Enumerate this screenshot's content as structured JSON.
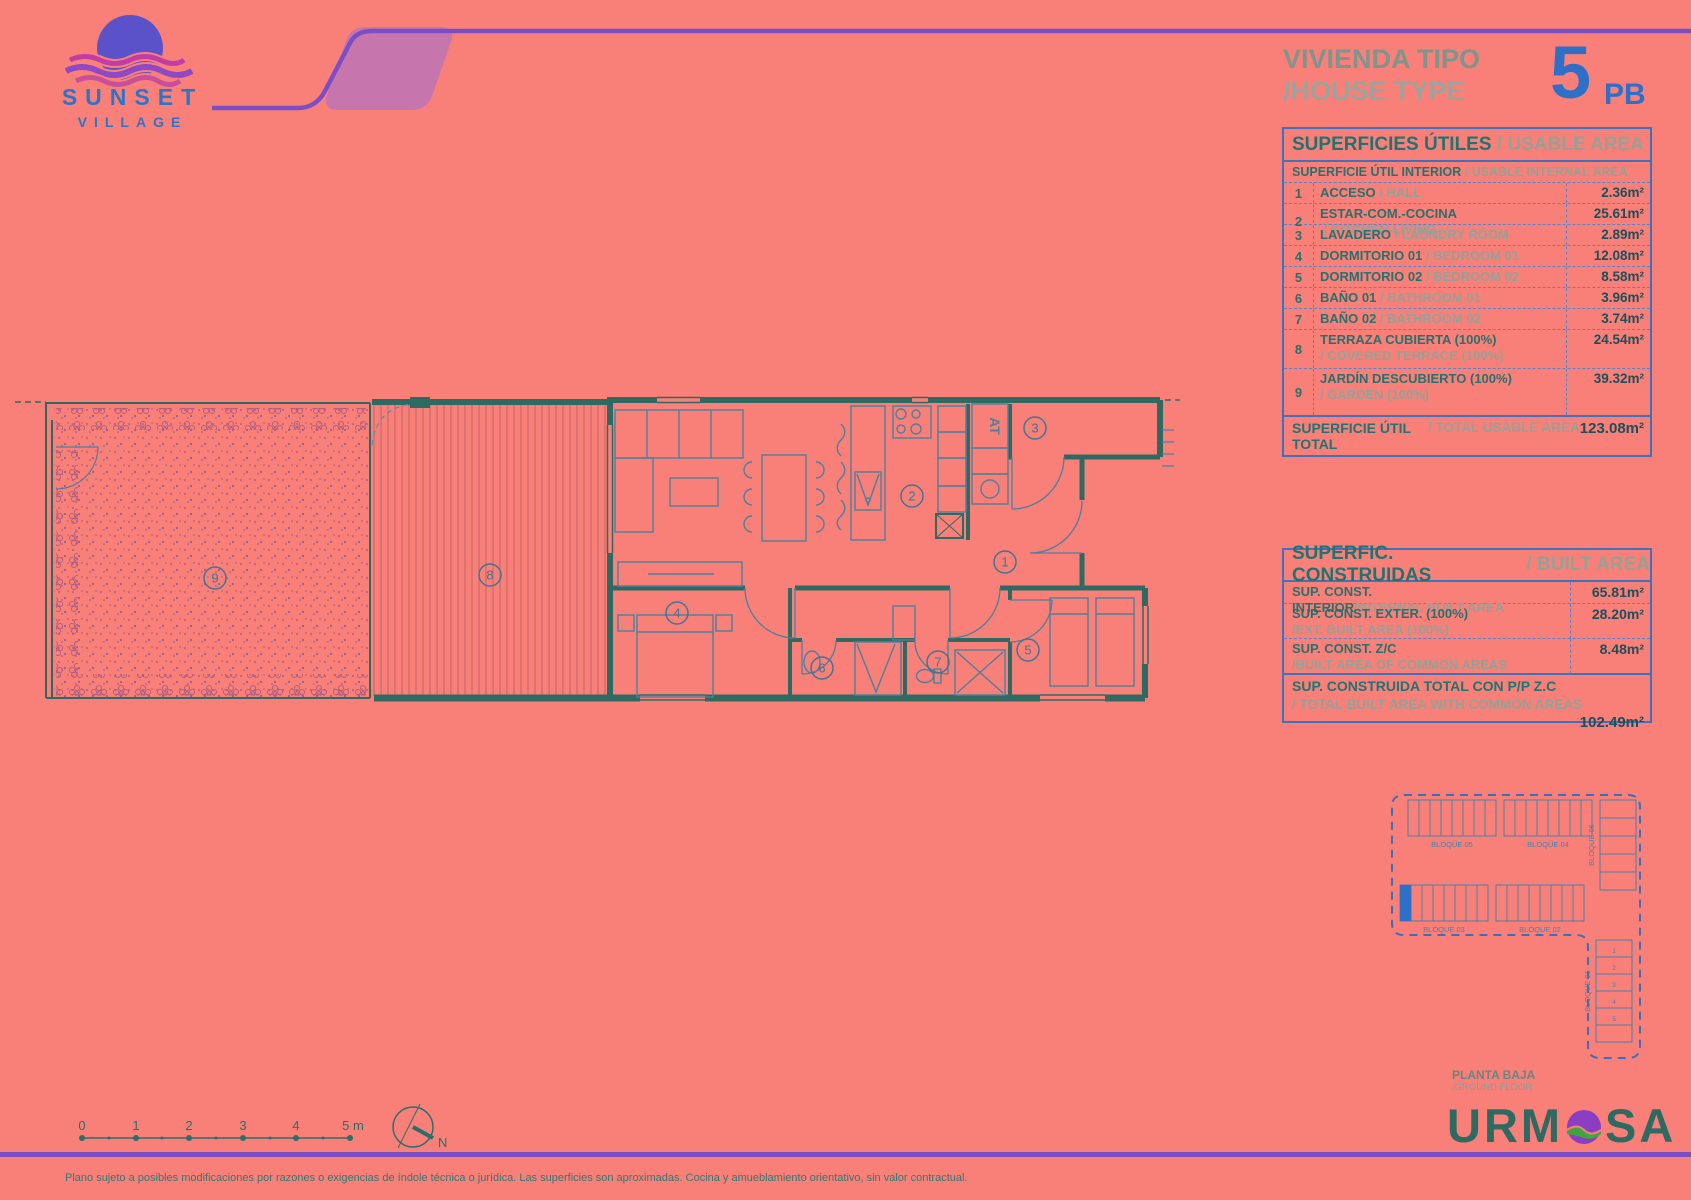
{
  "logo": {
    "name": "SUNSET",
    "subname": "VILLAGE"
  },
  "header": {
    "title_es": "VIVIENDA TIPO",
    "title_en": "/HOUSE TYPE",
    "unit_number": "5",
    "unit_suffix": "PB"
  },
  "usable_table": {
    "title_es": "SUPERFICIES ÚTILES",
    "title_en": " / USABLE AREA",
    "subtitle_es": "SUPERFICIE ÚTIL INTERIOR",
    "subtitle_en": " / USABLE INTERNAL AREA",
    "rows": [
      {
        "num": "1",
        "name_es": "ACCESO",
        "name_en": " / HALL",
        "area": "2.36m²",
        "stacked": false
      },
      {
        "num": "2",
        "name_es": "ESTAR-COM.-COCINA",
        "name_en": " / KITCHEN-LIVING",
        "area": "25.61m²",
        "stacked": false
      },
      {
        "num": "3",
        "name_es": "LAVADERO",
        "name_en": " / LAUNDRY ROOM",
        "area": "2.89m²",
        "stacked": false
      },
      {
        "num": "4",
        "name_es": "DORMITORIO 01",
        "name_en": " / BEDROOM 01",
        "area": "12.08m²",
        "stacked": false
      },
      {
        "num": "5",
        "name_es": "DORMITORIO 02",
        "name_en": " / BEDROOM 02",
        "area": "8.58m²",
        "stacked": false
      },
      {
        "num": "6",
        "name_es": "BAÑO 01",
        "name_en": " / BATHROOM 01",
        "area": "3.96m²",
        "stacked": false
      },
      {
        "num": "7",
        "name_es": "BAÑO 02",
        "name_en": " / BATHROOM 02",
        "area": "3.74m²",
        "stacked": false
      },
      {
        "num": "8",
        "name_es": "TERRAZA CUBIERTA (100%)",
        "name_en": "/ COVERED TERRACE (100%)",
        "area": "24.54m²",
        "stacked": true
      },
      {
        "num": "9",
        "name_es": "JARDÍN DESCUBIERTO (100%)",
        "name_en": "/ GARDEN (100%)",
        "area": "39.32m²",
        "stacked": true
      }
    ],
    "total_label_es": "SUPERFICIE ÚTIL TOTAL",
    "total_label_en": " / TOTAL USABLE AREA",
    "total_value": "123.08m²"
  },
  "built_table": {
    "title_es": "SUPERFIC. CONSTRUIDAS",
    "title_en": " / BUILT AREA",
    "rows": [
      {
        "label_es": "SUP. CONST. INTERIOR",
        "label_en": "/INTERNAL BUILT AREA",
        "value": "65.81m²",
        "stacked": false
      },
      {
        "label_es": "SUP. CONST. EXTER. (100%)",
        "label_en": "/EXT. BUILT AREA (100%)",
        "value": "28.20m²",
        "stacked": true
      },
      {
        "label_es": "SUP. CONST. Z/C",
        "label_en": "/BUILT AREA OF COMMON AREAS",
        "value": "8.48m²",
        "stacked": true
      }
    ],
    "total_label_es": "SUP. CONSTRUIDA TOTAL CON P/P Z.C",
    "total_label_en": "/ TOTAL BUILT AREA WITH COMMON AREAS",
    "total_value": "102.49m²"
  },
  "floor_plan": {
    "rooms": [
      {
        "num": "1"
      },
      {
        "num": "2"
      },
      {
        "num": "3"
      },
      {
        "num": "4"
      },
      {
        "num": "5"
      },
      {
        "num": "6"
      },
      {
        "num": "7"
      },
      {
        "num": "8"
      },
      {
        "num": "9"
      }
    ],
    "at_label": "AT"
  },
  "site_plan": {
    "blocks": {
      "top_left": "BLOQUE 05",
      "top_right": "BLOQUE 04",
      "right_vertical": "BLOQUE 06",
      "mid_left": "BLOQUE 03",
      "mid_right": "BLOQUE 02",
      "bottom_vertical": "BLOQUE 01"
    },
    "unit_digits": [
      "1",
      "2",
      "3",
      "4",
      "5"
    ],
    "caption_es": "PLANTA BAJA",
    "caption_en": "/GROUND FLOOR"
  },
  "scale_bar": {
    "ticks": [
      "0",
      "1",
      "2",
      "3",
      "4",
      "5 m"
    ]
  },
  "compass": {
    "label": "N"
  },
  "brand": {
    "left": "URM",
    "right": "SA"
  },
  "footer": {
    "disclaimer": "Plano sujeto a posibles modificaciones por razones o exigencias de índole técnica o jurídica. Las superficies son aproximadas. Cocina y amueblamiento orientativo, sin valor contractual."
  },
  "colors": {
    "background": "#F98078",
    "accent_blue": "#2E6FC8",
    "teal": "#26716E",
    "purple": "#7B4EC5",
    "wall": "#2E6A62"
  }
}
